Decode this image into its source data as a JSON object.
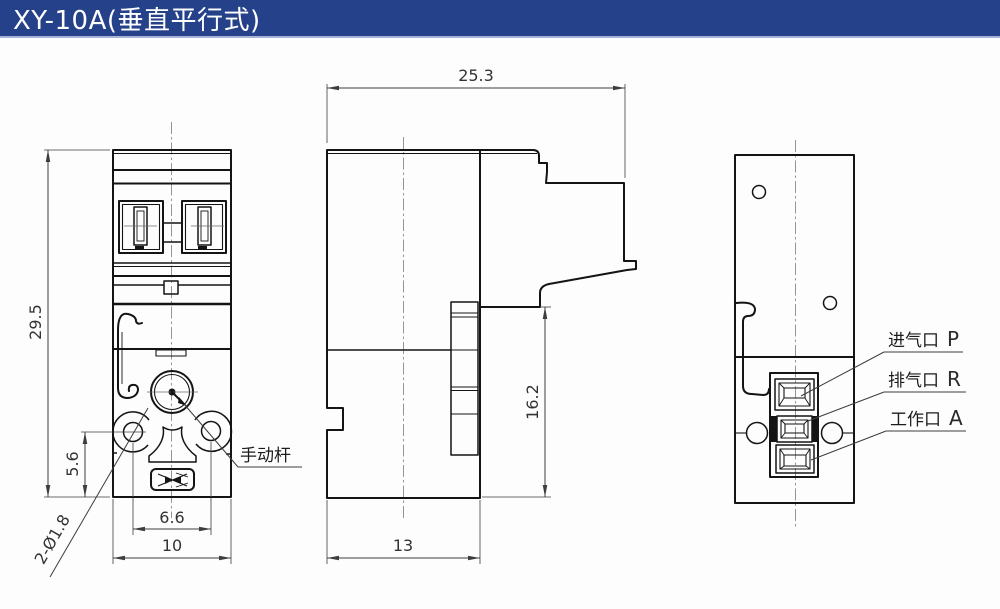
{
  "title": "XY-10A(垂直平行式)",
  "theme": {
    "header_bg": "#24418A",
    "header_underline": "#A8B2D6",
    "header_text": "#FFFFFF",
    "paper": "#FDFDFD",
    "object_line": "#141414",
    "dimension_line": "#3D3D3D"
  },
  "drawing": {
    "dimensions": {
      "front_height": "29.5",
      "lever_hole_offset": "5.6",
      "hole_spacing": "6.6",
      "front_width": "10",
      "overall_depth": "25.3",
      "body_depth": "13",
      "side_height": "16.2",
      "mount_holes": "2-Ø1.8"
    },
    "labels": {
      "manual_lever": "手动杆",
      "port_p": {
        "name": "进气口",
        "code": "P"
      },
      "port_r": {
        "name": "排气口",
        "code": "R"
      },
      "port_a": {
        "name": "工作口",
        "code": "A"
      }
    }
  }
}
